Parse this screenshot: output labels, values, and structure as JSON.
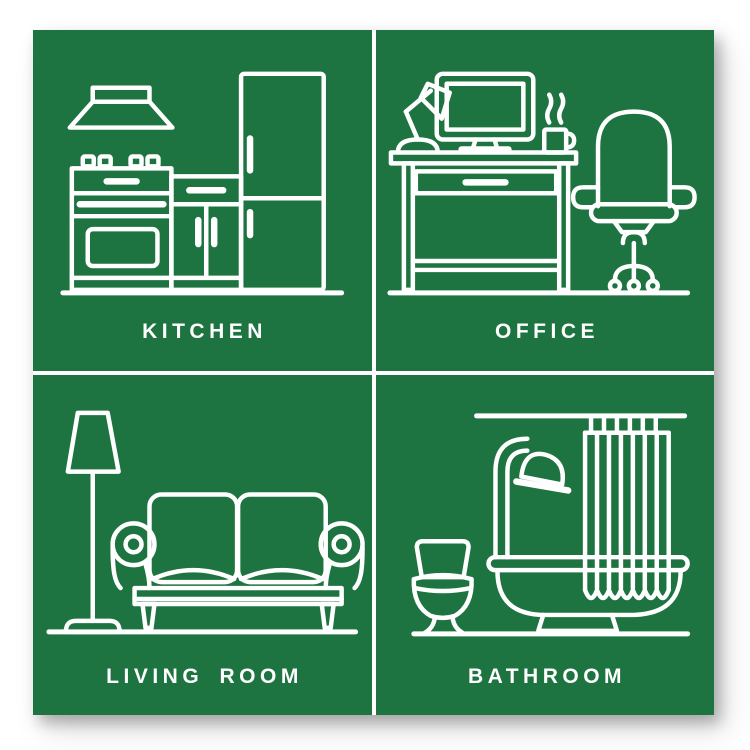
{
  "poster": {
    "page_background": "#ffffff",
    "background_color": "#1e7440",
    "line_color": "#ffffff",
    "label_color": "#ffffff",
    "panels": [
      {
        "id": "kitchen",
        "label": "KITCHEN",
        "icon": "kitchen-icon",
        "objects": [
          "range-hood",
          "stove-oven",
          "cabinet",
          "refrigerator"
        ]
      },
      {
        "id": "office",
        "label": "OFFICE",
        "icon": "office-icon",
        "objects": [
          "desk-lamp",
          "monitor",
          "steaming-mug",
          "desk",
          "office-chair"
        ]
      },
      {
        "id": "living-room",
        "label": "LIVING ROOM",
        "icon": "living-room-icon",
        "objects": [
          "floor-lamp",
          "sofa"
        ]
      },
      {
        "id": "bathroom",
        "label": "BATHROOM",
        "icon": "bathroom-icon",
        "objects": [
          "toilet",
          "shower-head",
          "bathtub",
          "shower-curtain"
        ]
      }
    ]
  }
}
